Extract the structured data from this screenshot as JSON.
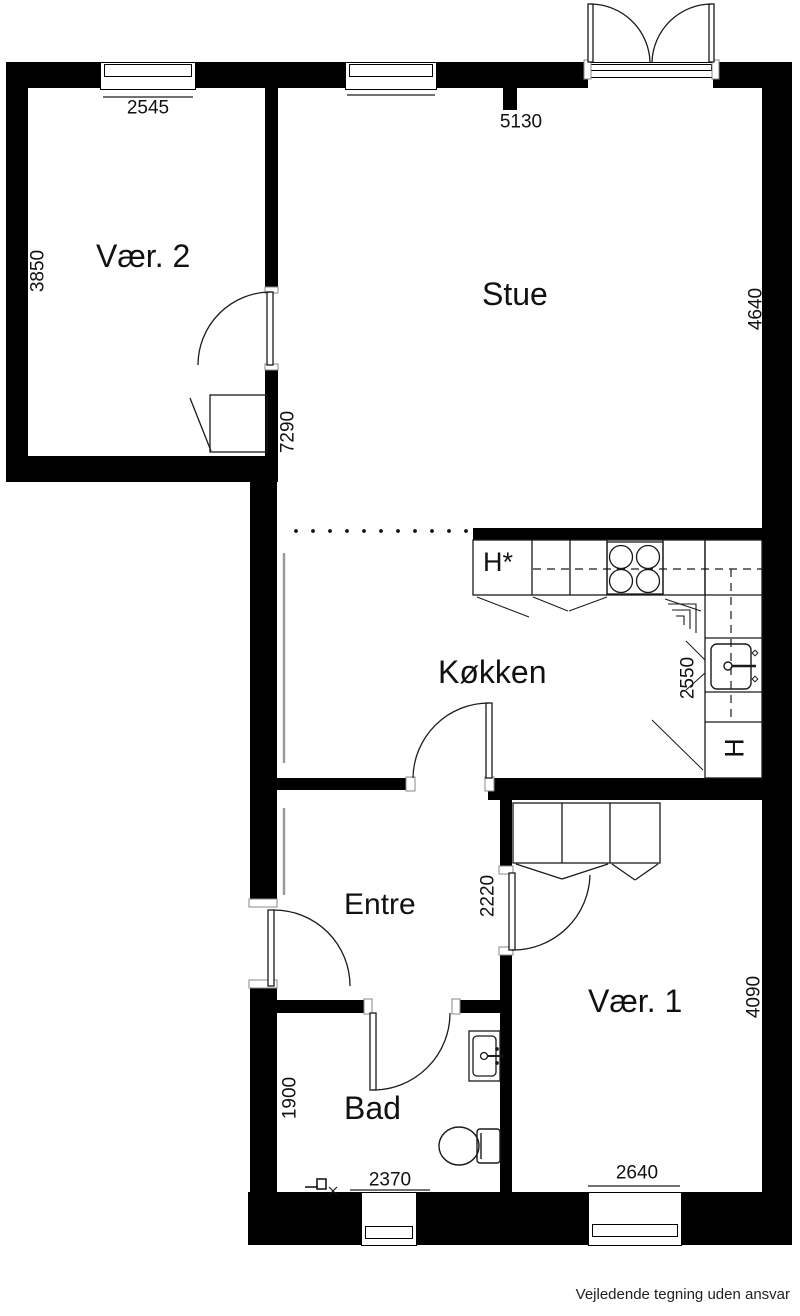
{
  "rooms": {
    "vaer2": {
      "label": "Vær. 2",
      "width_dim": "2545",
      "height_dim": "3850"
    },
    "stue": {
      "label": "Stue",
      "width_dim": "5130",
      "height_dim": "4640",
      "depth_dim": "7290"
    },
    "koekken": {
      "label": "Køkken",
      "height_dim": "2550",
      "fridge_label": "H*",
      "appliance_label": "H"
    },
    "entre": {
      "label": "Entre",
      "height_dim": "2220"
    },
    "vaer1": {
      "label": "Vær. 1",
      "height_dim": "4090",
      "width_dim": "2640"
    },
    "bad": {
      "label": "Bad",
      "height_dim": "1900",
      "width_dim": "2370"
    }
  },
  "footer": {
    "disclaimer": "Vejledende tegning uden ansvar"
  },
  "colors": {
    "wall": "#000000",
    "line": "#1a1a1a",
    "dimline": "#444444",
    "radiator": "#999999"
  }
}
